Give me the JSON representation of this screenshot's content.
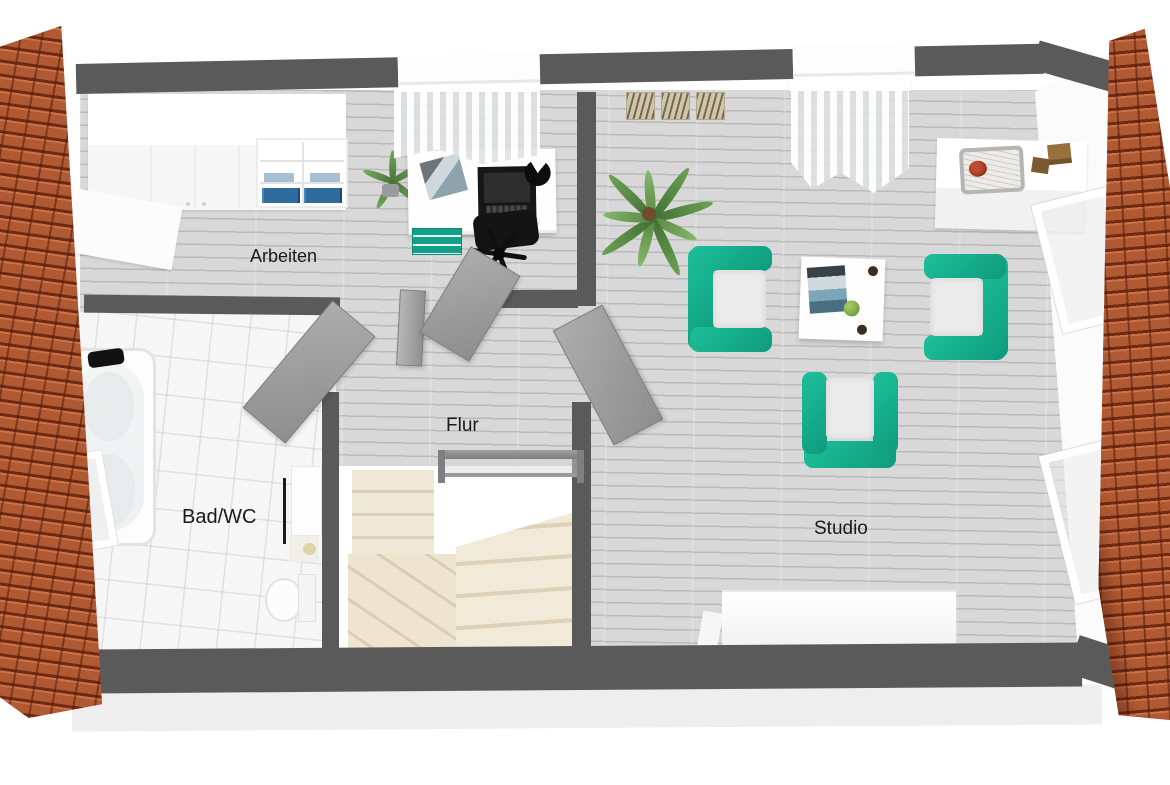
{
  "rooms": {
    "arbeiten": {
      "label": "Arbeiten"
    },
    "flur": {
      "label": "Flur"
    },
    "bad": {
      "label": "Bad/WC"
    },
    "studio": {
      "label": "Studio"
    }
  },
  "palette": {
    "accent_teal": "#17b392",
    "roof_orange": "#b05a33",
    "wall_gray": "#5a5a5a",
    "door_gray": "#9e9e9e",
    "floor_wood_gray": "#d8d8d8",
    "floor_tile_white": "#f6f6f6",
    "stair_cream": "#efe6d2",
    "binder_blue": "#2f6b9b"
  }
}
